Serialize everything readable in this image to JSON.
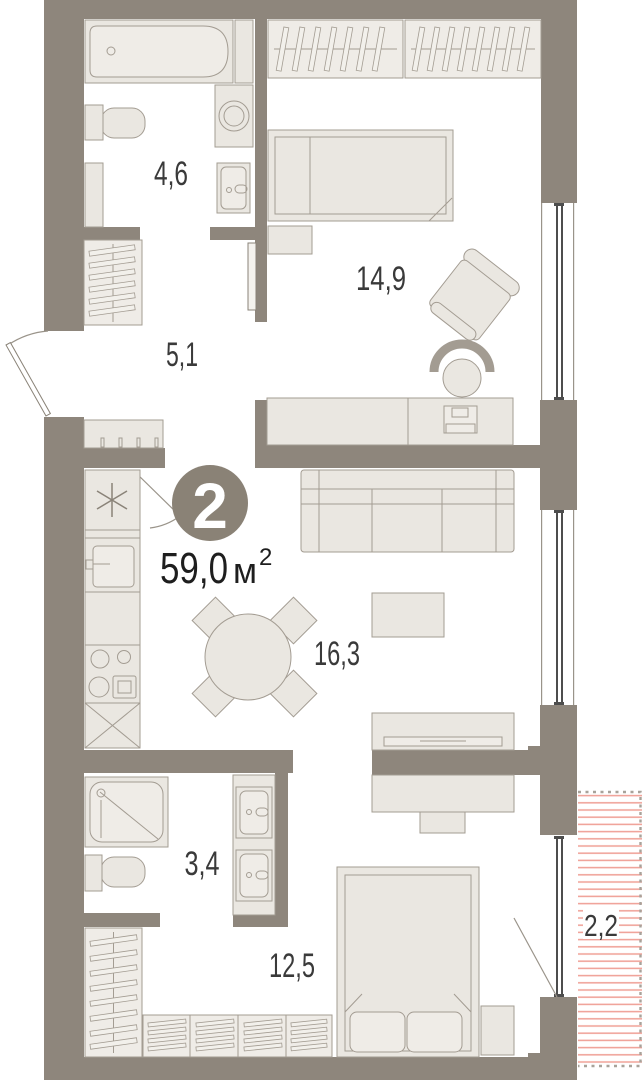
{
  "unit": {
    "number": "2",
    "area_value": "59,0",
    "area_unit": "м",
    "area_sup": "2"
  },
  "rooms": [
    {
      "name": "bathroom",
      "area": "4,6"
    },
    {
      "name": "hallway",
      "area": "5,1"
    },
    {
      "name": "bedroom",
      "area": "14,9"
    },
    {
      "name": "kitchen-living-room",
      "area": "16,3"
    },
    {
      "name": "bathroom-2",
      "area": "3,4"
    },
    {
      "name": "bedroom-2",
      "area": "12,5"
    },
    {
      "name": "balcony",
      "area": "2,2"
    }
  ],
  "colors": {
    "wall": "#8e867c",
    "furniture_fill": "#eae7e1",
    "furniture_stroke": "#a39c92",
    "balcony_hatch": "#f0a49b",
    "label_text": "#3a3a3a",
    "unit_circle": "#8a8276"
  }
}
